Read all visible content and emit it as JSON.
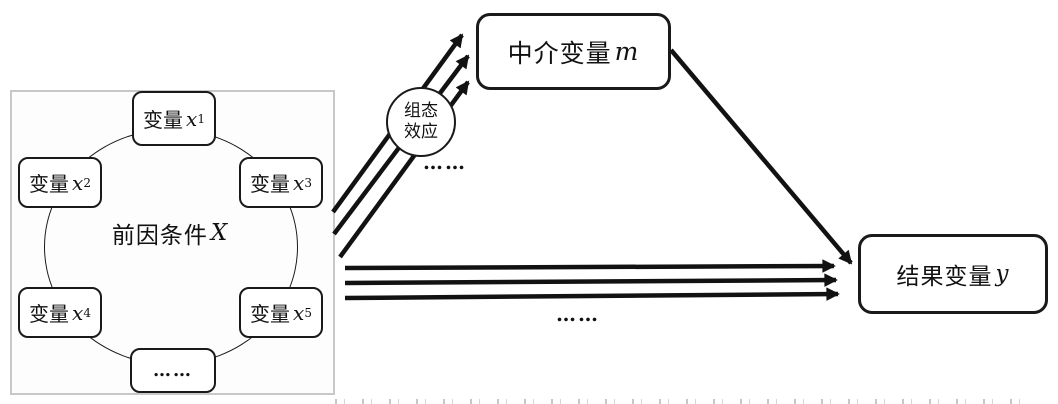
{
  "colors": {
    "line": "#121212",
    "box_border": "#1a1a1a",
    "panel_border": "#c8c8c8",
    "background": "#ffffff"
  },
  "antecedent": {
    "center_prefix": "前因条件",
    "center_var": "X",
    "items": [
      {
        "prefix": "变量",
        "var": "x",
        "sub": "1"
      },
      {
        "prefix": "变量",
        "var": "x",
        "sub": "2"
      },
      {
        "prefix": "变量",
        "var": "x",
        "sub": "3"
      },
      {
        "prefix": "变量",
        "var": "x",
        "sub": "4"
      },
      {
        "prefix": "变量",
        "var": "x",
        "sub": "5"
      }
    ],
    "ellipsis": "……"
  },
  "mediator": {
    "prefix": "中介变量",
    "var": "m"
  },
  "outcome": {
    "prefix": "结果变量",
    "var": "y"
  },
  "effect_circle": {
    "line1": "组态",
    "line2": "效应"
  },
  "ellipsis_upper": "……",
  "ellipsis_lower": "……"
}
